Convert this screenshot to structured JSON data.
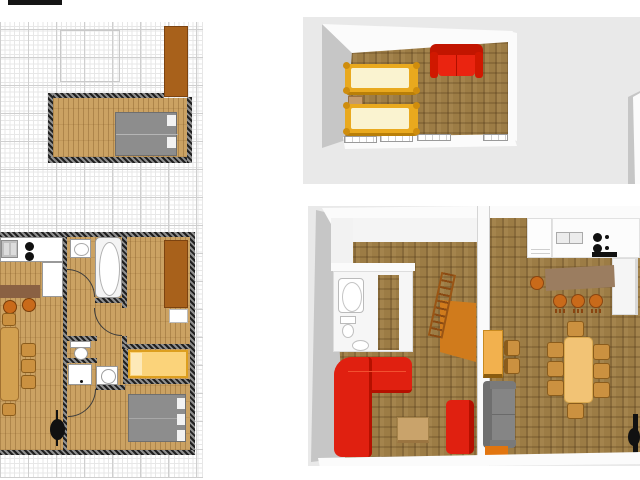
{
  "app": {
    "type": "home-design-viewer",
    "text_visible": false
  },
  "colors": {
    "grid-minor": "#e7e7e7",
    "grid-major": "#cfcfcf",
    "wood2d": "#cba263",
    "wood3d": "#9c7c45",
    "backdrop": "#e9e9e9",
    "wall3d": "#fbfbfb",
    "wall3d-shade": "#c6c6c6",
    "wardrobe": "#a8611b",
    "bed-gray": "#8d8d8d",
    "bed-frame": "#e9a91e",
    "bed-mat": "#faf3d0",
    "bed-yellow-2d": "#fbd37a",
    "sofa-red": "#e02010",
    "sofa-gray": "#858585",
    "bar-2d": "#8a6143",
    "bar-3d": "#9b7d60",
    "stool": "#c96a1a",
    "table-2d": "#d2a050",
    "table-3d": "#f2c375",
    "chair": "#cb9140",
    "dresser": "#f2b14e",
    "panel-orange": "#d07b1c",
    "ladder": "#b5651d",
    "stove-black": "#111111"
  },
  "plan2d": {
    "grid": {
      "visible": true,
      "minor_step_px": 4.7,
      "major_step_px": 28
    },
    "upper_room": {
      "furniture": [
        "double-bed-gray",
        "wardrobe-brown"
      ]
    },
    "main_floor": {
      "rooms": [
        "kitchen-dining",
        "bathroom",
        "wc",
        "washroom",
        "hall",
        "bedroom",
        "bed-niche"
      ],
      "kitchen": [
        "kitchen-sink",
        "cooktop-2-burners",
        "counter-L",
        "bar-counter",
        "bar-stool",
        "bar-stool"
      ],
      "dining": [
        "dining-table",
        "chair",
        "chair",
        "chair",
        "chair",
        "chair"
      ],
      "bathroom": [
        "washbasin",
        "bathtub",
        "door-arc"
      ],
      "wc": [
        "toilet",
        "door-arc"
      ],
      "washroom": [
        "washbasin-counter",
        "washing-machine",
        "door-arc"
      ],
      "bedroom": [
        "wardrobe-brown",
        "shelf-white",
        "single-bed-yellow",
        "double-bed-gray",
        "pellet-stove-black"
      ]
    }
  },
  "view3d_top": {
    "room": "upstairs-bedroom",
    "furniture": [
      "single-bed-yellow",
      "single-bed-yellow",
      "nightstand",
      "sofa-red-2-seat"
    ],
    "windows_on_south_wall": 4
  },
  "view3d_bottom": {
    "left_room": [
      "corridor",
      "bathtub",
      "toilet",
      "washbasin",
      "loft-ladder",
      "orange-panel",
      "corner-sofa-red",
      "loveseat-red",
      "coffee-table"
    ],
    "right_room": [
      "fridge-cabinet",
      "kitchen-sink",
      "cooktop-4-burners",
      "tall-cabinet",
      "bar-counter",
      "bar-stool",
      "bar-stool",
      "bar-stool",
      "bar-stool",
      "yellow-dresser",
      "chair",
      "chair",
      "sofa-gray",
      "dining-table",
      "chairs-8",
      "wood-stove-black",
      "orange-bench"
    ]
  }
}
